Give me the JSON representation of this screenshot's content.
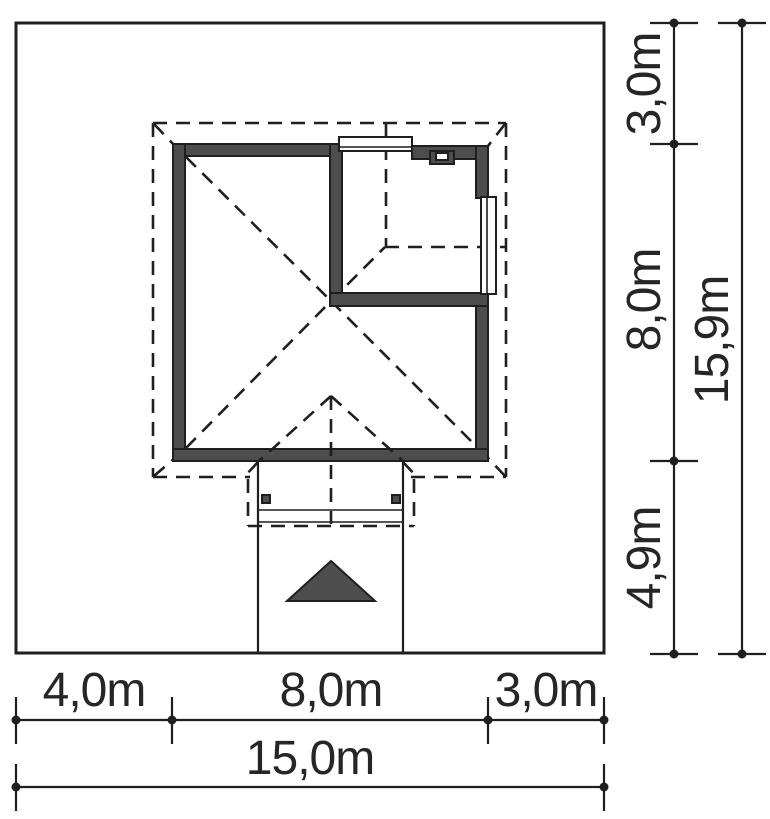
{
  "diagram": {
    "kind": "architectural-plot-site-plan",
    "icons": {
      "entrance_arrow": "triangle-up"
    }
  },
  "dimensions": {
    "vertical": {
      "segments": [
        {
          "label": "3,0m",
          "meters": 3.0
        },
        {
          "label": "8,0m",
          "meters": 8.0
        },
        {
          "label": "4,9m",
          "meters": 4.9
        }
      ],
      "total": {
        "label": "15,9m",
        "meters": 15.9
      }
    },
    "horizontal": {
      "segments": [
        {
          "label": "4,0m",
          "meters": 4.0
        },
        {
          "label": "8,0m",
          "meters": 8.0
        },
        {
          "label": "3,0m",
          "meters": 3.0
        }
      ],
      "total": {
        "label": "15,0m",
        "meters": 15.0
      }
    }
  },
  "colors": {
    "line": "#1f1f1f",
    "wall": "#4d4d4d",
    "text": "#262626",
    "paper": "#ffffff"
  }
}
